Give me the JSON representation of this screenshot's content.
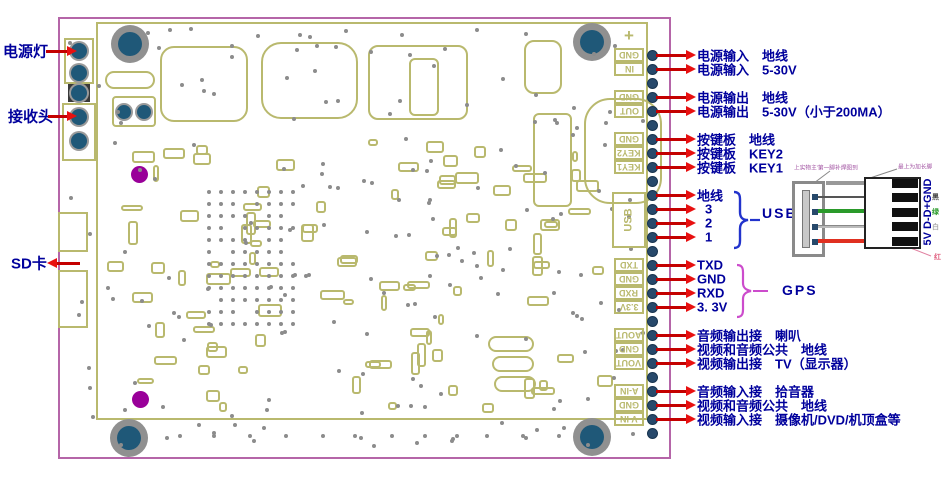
{
  "board": {
    "type": "pcb-pinout-diagram",
    "border_color": "#b565a8",
    "silk_color": "#b9b96e",
    "hole_color": "#1f5878",
    "label_color": "#00009c",
    "arrow_color": "#e81010",
    "plus_mark": "+"
  },
  "left_labels": [
    {
      "text": "电源灯",
      "x": 3,
      "y": 51,
      "arrow_dir": "right",
      "ax1": 46,
      "ax2": 77
    },
    {
      "text": "接收头",
      "x": 8,
      "y": 116,
      "arrow_dir": "right",
      "ax1": 48,
      "ax2": 77
    },
    {
      "text": "SD卡",
      "x": 11,
      "y": 263,
      "arrow_dir": "left",
      "ax1": 47,
      "ax2": 80
    }
  ],
  "pins": {
    "x": 652,
    "y_start": 55,
    "spacing": 14,
    "count": 28
  },
  "right_labels": [
    {
      "dot": 0,
      "text": "电源输入　地线"
    },
    {
      "dot": 1,
      "text": "电源输入　5-30V"
    },
    {
      "dot": 3,
      "text": "电源输出　地线"
    },
    {
      "dot": 4,
      "text": "电源输出　5-30V（小于200MA）"
    },
    {
      "dot": 6,
      "text": "按键板　地线"
    },
    {
      "dot": 7,
      "text": "按键板　KEY2"
    },
    {
      "dot": 8,
      "text": "按键板　KEY1"
    },
    {
      "dot": 10,
      "text": "地线"
    },
    {
      "dot": 11,
      "text": "3",
      "indent": 8
    },
    {
      "dot": 12,
      "text": "2",
      "indent": 8
    },
    {
      "dot": 13,
      "text": "1",
      "indent": 8
    },
    {
      "dot": 15,
      "text": "TXD"
    },
    {
      "dot": 16,
      "text": "GND"
    },
    {
      "dot": 17,
      "text": "RXD"
    },
    {
      "dot": 18,
      "text": "3. 3V"
    },
    {
      "dot": 20,
      "text": "音频输出接　喇叭"
    },
    {
      "dot": 21,
      "text": "视频和音频公共　地线"
    },
    {
      "dot": 22,
      "text": "视频输出接　TV（显示器）"
    },
    {
      "dot": 24,
      "text": "音频输入接　拾音器"
    },
    {
      "dot": 25,
      "text": "视频和音频公共　地线"
    },
    {
      "dot": 26,
      "text": "视频输入接　摄像机/DVD/机顶盒等"
    }
  ],
  "edge_pads": [
    {
      "text": "GND",
      "y": 48
    },
    {
      "text": "IN",
      "y": 62
    },
    {
      "text": "GND",
      "y": 90
    },
    {
      "text": "OUT",
      "y": 104
    },
    {
      "text": "GND",
      "y": 132
    },
    {
      "text": "KEY2",
      "y": 146
    },
    {
      "text": "KEY1",
      "y": 160
    },
    {
      "text": "USB",
      "y": 192,
      "h": 56,
      "vertical": true
    },
    {
      "text": "TXD",
      "y": 258
    },
    {
      "text": "GND",
      "y": 272
    },
    {
      "text": "RXD",
      "y": 286
    },
    {
      "text": "3.3V",
      "y": 300
    },
    {
      "text": "AOUT",
      "y": 328
    },
    {
      "text": "GND",
      "y": 342
    },
    {
      "text": "VOUT",
      "y": 356
    },
    {
      "text": "A-IN",
      "y": 384
    },
    {
      "text": "GND",
      "y": 398
    },
    {
      "text": "V-IN",
      "y": 412
    }
  ],
  "groups": {
    "usb": {
      "label": "USB",
      "brace_color": "#2233cc"
    },
    "gps": {
      "label": "GPS",
      "brace_color": "#cc4ccc"
    }
  },
  "usb_diagram": {
    "vertical_pin_label": "5V D-D+GND",
    "note_left": "上实物主'第一脚补焊图到",
    "note_right": "最上为加长脚",
    "wire_color_labels": [
      "黑",
      "绿",
      "白",
      "红"
    ],
    "wire_colors": {
      "shield": "#999999",
      "data_minus": "#555555",
      "data_plus": "#2a9a2a",
      "white": "#bbbbbb",
      "power": "#e03020"
    }
  }
}
